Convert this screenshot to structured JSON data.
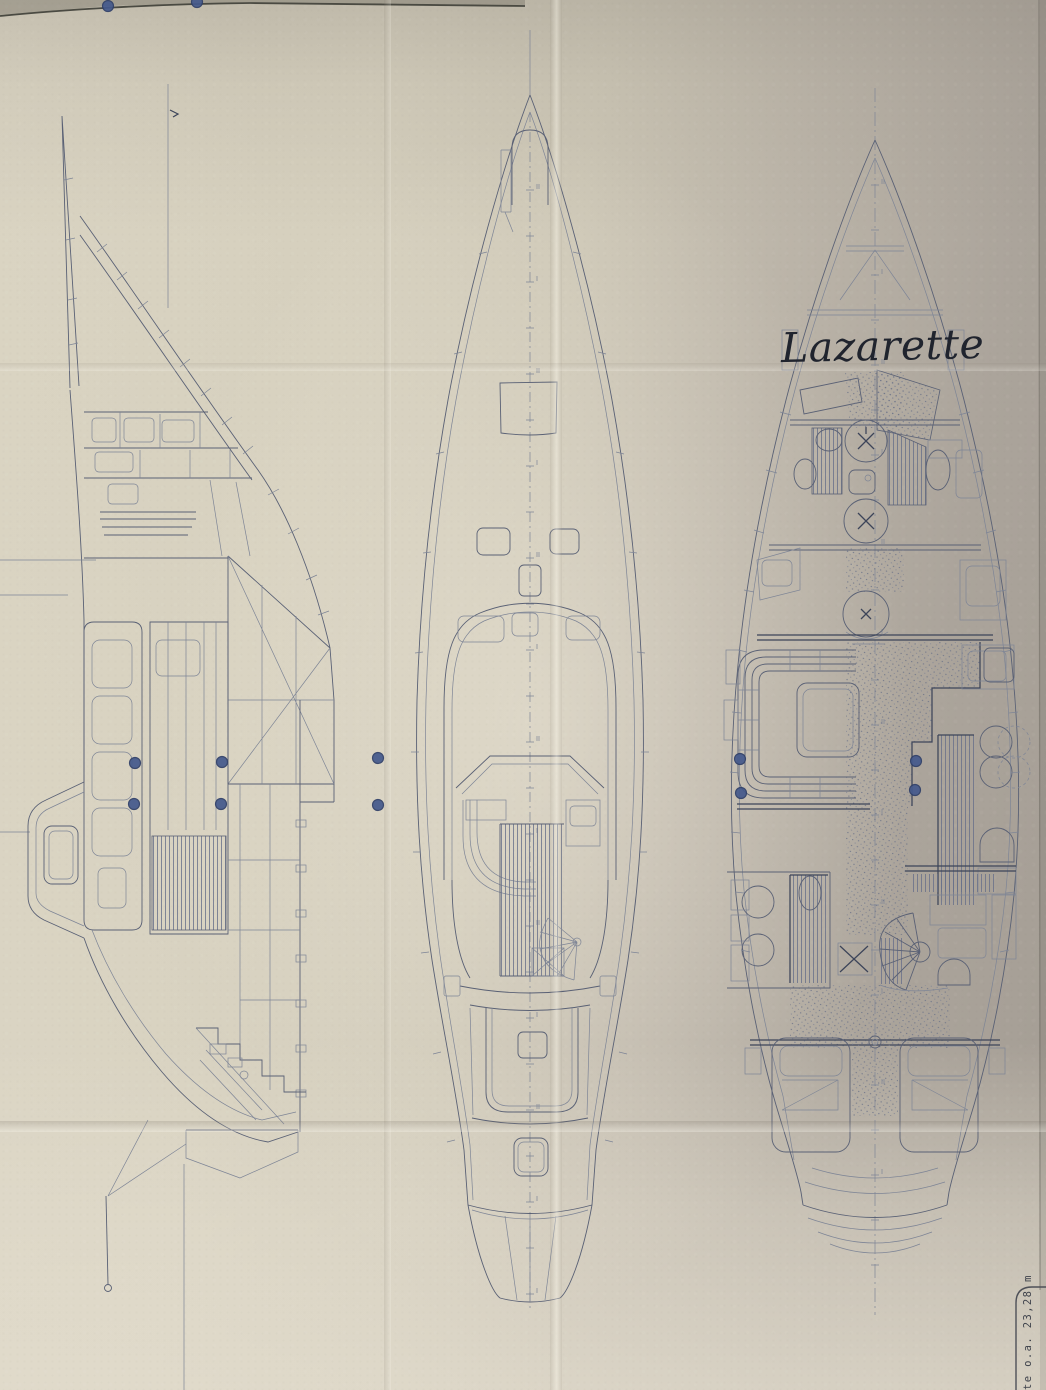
{
  "figure": {
    "kind": "photographed-yacht-arrangement-drawing",
    "views": [
      {
        "id": "profile-section-view"
      },
      {
        "id": "deck-plan-view"
      },
      {
        "id": "interior-plan-view"
      }
    ]
  },
  "annotations": {
    "lazarette_label": "Lazarette"
  },
  "title_block": {
    "vertical_text": "te o.a.  23,28 m"
  },
  "colors": {
    "paper_light": "#ddd7c4",
    "paper_mid": "#cdc7b7",
    "paper_shadow": "#a49d94",
    "ink": "#5a6175",
    "ink_dark": "#3c4459",
    "fastener_blue": "#44598c",
    "fastener_blue_dark": "#2f3f68"
  },
  "fasteners": {
    "dots": [
      [
        108,
        6
      ],
      [
        197,
        2
      ],
      [
        135,
        763
      ],
      [
        134,
        804
      ],
      [
        222,
        762
      ],
      [
        221,
        804
      ],
      [
        378,
        758
      ],
      [
        378,
        805
      ],
      [
        740,
        759
      ],
      [
        741,
        793
      ],
      [
        916,
        761
      ],
      [
        915,
        790
      ]
    ]
  }
}
